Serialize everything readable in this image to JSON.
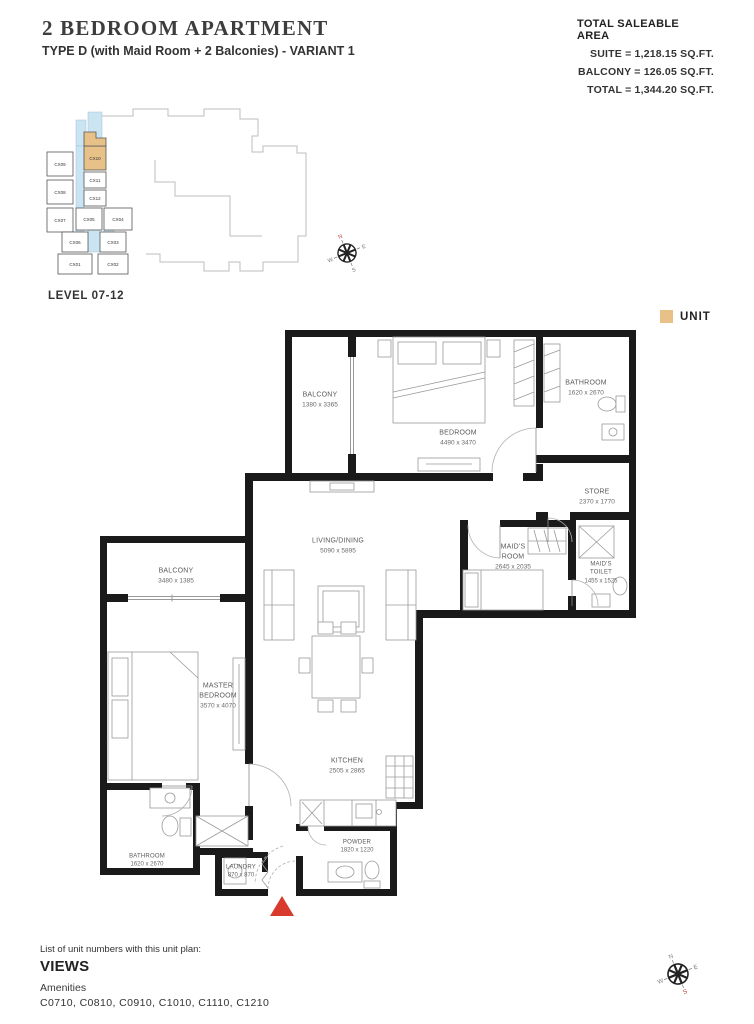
{
  "header": {
    "title": "2 BEDROOM APARTMENT",
    "subtitle": "TYPE D (with Maid Room + 2 Balconies) - VARIANT 1"
  },
  "area_summary": {
    "title": "TOTAL SALEABLE AREA",
    "lines": [
      "SUITE = 1,218.15 SQ.FT.",
      "BALCONY = 126.05 SQ.FT.",
      "TOTAL = 1,344.20 SQ.FT."
    ]
  },
  "key_plan": {
    "level_label": "LEVEL 07-12",
    "highlighted_unit": "CX10",
    "units": [
      "CX09",
      "CX10",
      "CX11",
      "CX12",
      "CX08",
      "CX07",
      "CX05",
      "CX04",
      "CX06",
      "CX03",
      "CX01",
      "CX02"
    ]
  },
  "legend": {
    "unit_label": "UNIT"
  },
  "colors": {
    "unit_highlight": "#E8C189",
    "key_plan_corridor": "#CBE4F2",
    "entrance_marker": "#D93A2E",
    "walls": "#1A1A1A"
  },
  "compass": {
    "letters": [
      "N",
      "E",
      "S",
      "W"
    ]
  },
  "rooms": [
    {
      "name": "BALCONY",
      "dims": "1380 x 3365"
    },
    {
      "name": "BEDROOM",
      "dims": "4490 x 3470"
    },
    {
      "name": "BATHROOM",
      "dims": "1620 x 2670"
    },
    {
      "name": "STORE",
      "dims": "2370 x 1770"
    },
    {
      "name": "MAID'S ROOM",
      "dims": "2645 x 2035"
    },
    {
      "name": "MAID'S TOILET",
      "dims": "1455 x 1525"
    },
    {
      "name": "LIVING/DINING",
      "dims": "5090 x 5895"
    },
    {
      "name": "BALCONY",
      "dims": "3480 x 1385"
    },
    {
      "name": "MASTER BEDROOM",
      "dims": "3570 x 4070"
    },
    {
      "name": "KITCHEN",
      "dims": "2505 x 2865"
    },
    {
      "name": "BATHROOM",
      "dims": "1620 x 2670"
    },
    {
      "name": "LAUNDRY",
      "dims": "870 x 870"
    },
    {
      "name": "POWDER",
      "dims": "1820 x 1220"
    }
  ],
  "footer": {
    "list_label": "List of unit numbers with this unit plan:",
    "views_label": "VIEWS",
    "amenities_label": "Amenities",
    "unit_numbers": "C0710, C0810, C0910, C1010, C1110, C1210"
  }
}
